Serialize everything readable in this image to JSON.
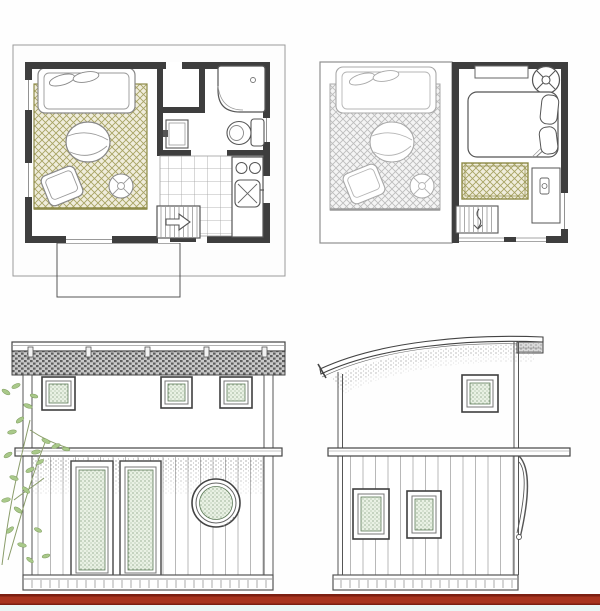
{
  "palette": {
    "background": "#fefefe",
    "line_dark": "#3f3f3f",
    "line_medium": "#6e6e6e",
    "line_light": "#a8a8a8",
    "wall_fill": "#3e3e3e",
    "rug_line": "#a7a363",
    "rug_bg": "#f0eddc",
    "rug_edge": "#8e8b49",
    "ghost_line": "#a8a8a8",
    "glass_bg": "#e9f1e4",
    "glass_dot": "#6c8a66",
    "glass_frame": "#5d7a58",
    "fascia_light": "#c9c9c9",
    "fascia_dark": "#5d5d5d",
    "stipple_dot": "#6f6f6f",
    "siding_line": "#b8b8b8",
    "tile_line": "#9f9f9f",
    "tree_leaf": "#a9c98a",
    "tree_stem": "#8a9c6a",
    "ground_dark": "#7c1f12",
    "ground_red": "#a8341f",
    "ground_strip": "#eaf6f5"
  },
  "drawing": {
    "panels": [
      {
        "name": "first-floor-plan",
        "rooms": [
          "living-area",
          "closet",
          "bathroom",
          "kitchen"
        ],
        "objects": [
          "daybed-sofa",
          "area-rug",
          "round-coffee-table",
          "armchair",
          "side-stool",
          "corner-shower",
          "toilet",
          "vanity-sink",
          "kitchen-counter",
          "double-sink",
          "cooktop",
          "tile-floor",
          "staircase-up-arrow",
          "entry-porch-outline"
        ]
      },
      {
        "name": "loft-floor-plan",
        "rooms": [
          "ghost-living-room-below",
          "loft-bedroom"
        ],
        "objects": [
          "ghost-sofa",
          "ghost-rug",
          "ghost-table",
          "ghost-armchair",
          "ghost-stool",
          "wardrobe-shelf",
          "ceiling-fan",
          "bed",
          "pillows",
          "accent-rug",
          "desk-cabinet",
          "staircase"
        ]
      },
      {
        "name": "front-elevation",
        "objects": [
          "flat-roof-slab",
          "fascia-band",
          "rafter-tails",
          "corner-posts",
          "square-window",
          "square-window",
          "square-window",
          "floor-band",
          "shadow-hatch",
          "vertical-siding",
          "glazed-door",
          "glazed-door",
          "porthole-window",
          "base-board",
          "tree-foliage"
        ]
      },
      {
        "name": "side-elevation",
        "objects": [
          "curved-shed-roof",
          "roof-hatch",
          "square-window",
          "floor-band",
          "corbel-bracket",
          "vertical-siding",
          "square-window",
          "square-window",
          "base-board"
        ]
      }
    ],
    "ground_line": {
      "color": "#a8341f"
    }
  }
}
